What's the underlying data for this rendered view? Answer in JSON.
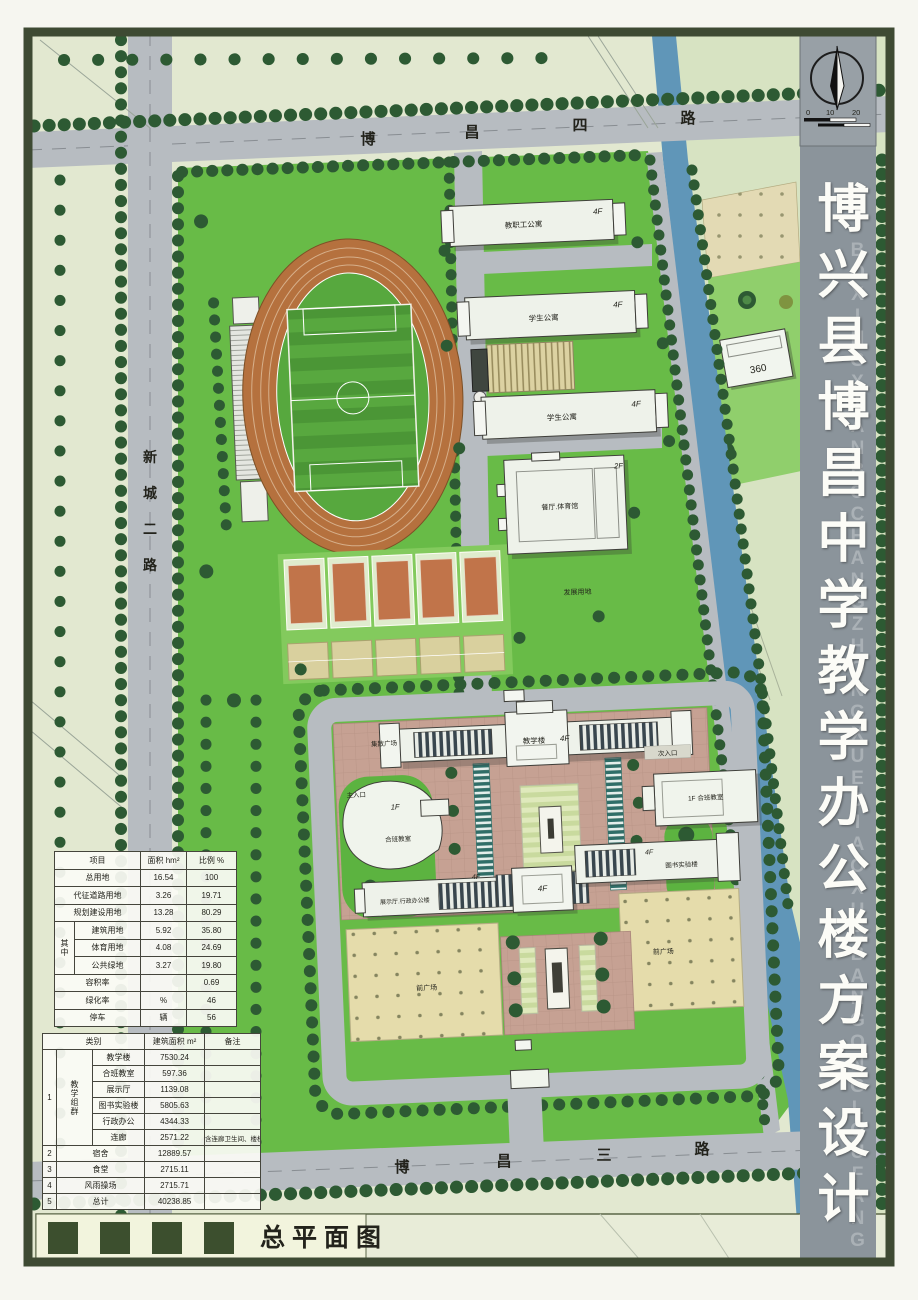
{
  "drawing": {
    "name_label": "总平面图"
  },
  "compass": {
    "ticks": [
      "0",
      "10",
      "20"
    ]
  },
  "sidebar": {
    "title": "博兴县博昌中学教学办公楼方案设计",
    "watermark": "BOXINGXIANBOCHANGZHONGXUEJIAOXUEBANGONGLOUFANGANSHEJI"
  },
  "roads": {
    "top": [
      "博",
      "昌",
      "四",
      "路"
    ],
    "left": [
      "新",
      "城",
      "二",
      "路"
    ],
    "bottom": [
      "博",
      "昌",
      "三",
      "路"
    ]
  },
  "site": {
    "main_entrance": "主入口",
    "secondary_entrance": "次入口",
    "gathering_plaza": "集散广场",
    "front_plaza": "前广场",
    "development_land": "发展用地",
    "neighbor_marker": "360"
  },
  "buildings": {
    "staff_apartment": {
      "name": "教职工公寓",
      "floors": "4F"
    },
    "student_apartment_a": {
      "name": "学生公寓",
      "floors": "4F"
    },
    "student_apartment_b": {
      "name": "学生公寓",
      "floors": "4F"
    },
    "canteen_gym": {
      "name": "餐厅.体育馆",
      "floors": "2F"
    },
    "teaching": {
      "name": "教学楼",
      "floors": "4F"
    },
    "combined_class_west": {
      "name": "合班教室",
      "floors": "1F"
    },
    "combined_class_east": {
      "name": "1F 合班教室"
    },
    "exhibit_admin": {
      "name": "展示厅.行政办公楼",
      "floors": "4F"
    },
    "center_block": {
      "floors": "4F"
    },
    "library_lab": {
      "name": "图书实验楼",
      "floors": "4F"
    }
  },
  "colors": {
    "campus_green": "#68bb47",
    "river_blue": "#6096b8",
    "road_grey": "#b7bcc1",
    "track_orange": "#b5713e",
    "sidebar_grey": "#8b949b",
    "frame_olive": "#3e4a33"
  },
  "tables": {
    "land_use": {
      "header": {
        "item": "项目",
        "area": "面积 hm²",
        "ratio": "比例 %"
      },
      "rows": [
        {
          "item": "总用地",
          "area": "16.54",
          "ratio": "100"
        },
        {
          "item": "代征道路用地",
          "area": "3.26",
          "ratio": "19.71"
        },
        {
          "item": "规划建设用地",
          "area": "13.28",
          "ratio": "80.29"
        }
      ],
      "group_label": "其中",
      "group_rows": [
        {
          "item": "建筑用地",
          "area": "5.92",
          "ratio": "35.80"
        },
        {
          "item": "体育用地",
          "area": "4.08",
          "ratio": "24.69"
        },
        {
          "item": "公共绿地",
          "area": "3.27",
          "ratio": "19.80"
        }
      ],
      "tail_rows": [
        {
          "item": "容积率",
          "area": "",
          "ratio": "0.69"
        },
        {
          "item": "绿化率",
          "area": "%",
          "ratio": "46"
        },
        {
          "item": "停车",
          "area": "辆",
          "ratio": "56"
        }
      ]
    },
    "floor_area": {
      "header": {
        "category": "类别",
        "area": "建筑面积 m²",
        "remark": "备注"
      },
      "group": {
        "no": "1",
        "label": "教学组群",
        "rows": [
          {
            "item": "教学楼",
            "area": "7530.24",
            "remark": ""
          },
          {
            "item": "合班教室",
            "area": "597.36",
            "remark": ""
          },
          {
            "item": "展示厅",
            "area": "1139.08",
            "remark": ""
          },
          {
            "item": "图书实验楼",
            "area": "5805.63",
            "remark": ""
          },
          {
            "item": "行政办公",
            "area": "4344.33",
            "remark": ""
          },
          {
            "item": "连廊",
            "area": "2571.22",
            "remark": "含连廊卫生间、楼梯"
          }
        ]
      },
      "rows": [
        {
          "no": "2",
          "item": "宿舍",
          "area": "12889.57",
          "remark": ""
        },
        {
          "no": "3",
          "item": "食堂",
          "area": "2715.11",
          "remark": ""
        },
        {
          "no": "4",
          "item": "风雨操场",
          "area": "2715.71",
          "remark": ""
        },
        {
          "no": "5",
          "item": "总计",
          "area": "40238.85",
          "remark": ""
        }
      ]
    }
  }
}
